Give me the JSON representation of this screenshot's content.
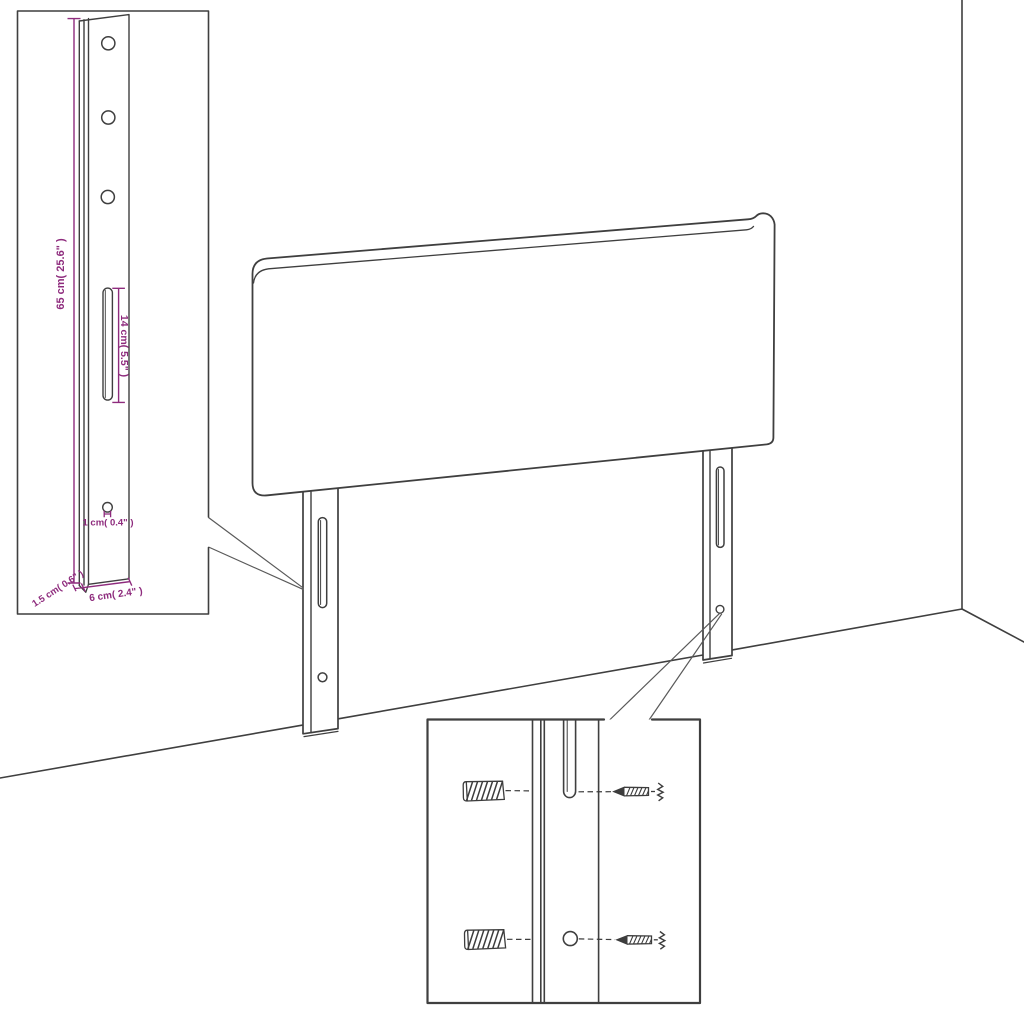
{
  "colors": {
    "line": "#3f3f3f",
    "inset_border": "#2f2f2f",
    "dimension_text": "#8e2b7d",
    "background": "#ffffff"
  },
  "dimension_labels": {
    "height": "65 cm( 25.6\" )",
    "slot_length": "14 cm( 5.5\" )",
    "hole_diameter": "1 cm( 0.4\" )",
    "bottom_thickness": "1.5 cm( 0.6\" )",
    "bottom_width": "6 cm( 2.4\" )"
  }
}
